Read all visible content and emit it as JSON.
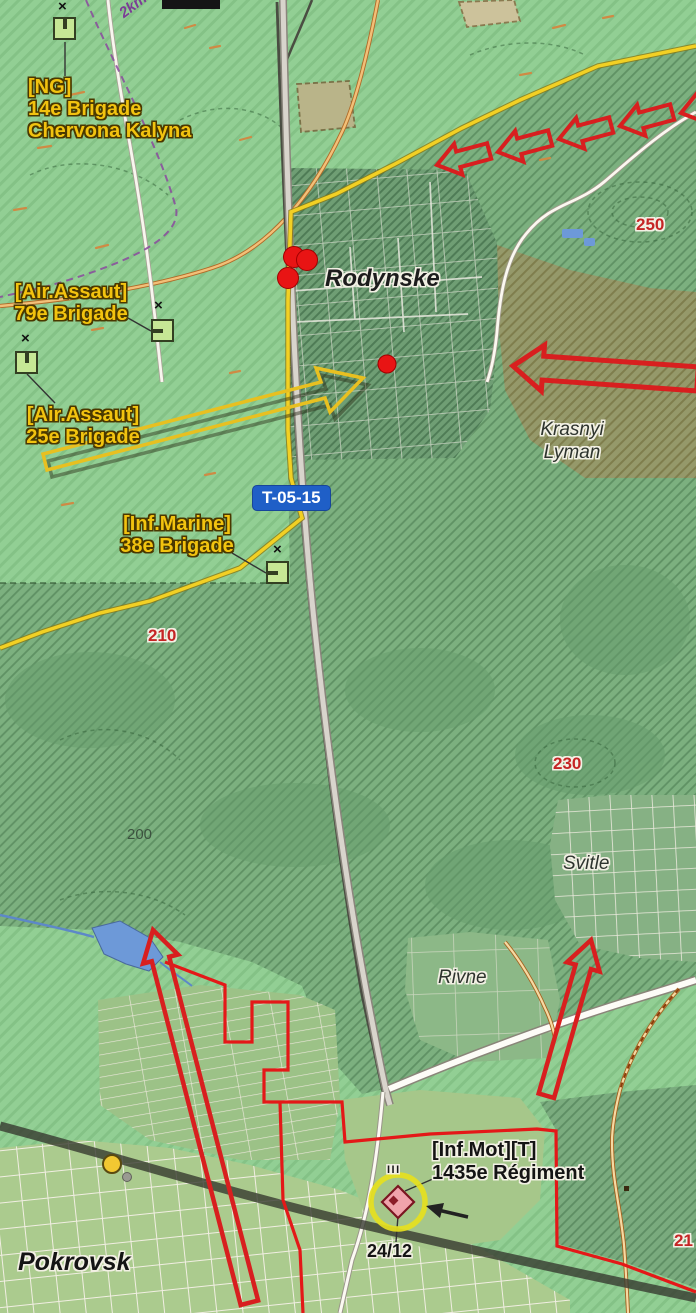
{
  "labels": {
    "units": [
      {
        "id": "ng-14",
        "lines": [
          "[NG]",
          "14e Brigade",
          "Chervona Kalyna"
        ]
      },
      {
        "id": "airassault-79",
        "lines": [
          "[Air.Assaut]",
          "79e Brigade"
        ]
      },
      {
        "id": "airassault-25",
        "lines": [
          "[Air.Assaut]",
          "25e Brigade"
        ]
      },
      {
        "id": "marine-38",
        "lines": [
          "[Inf.Marine]",
          "38e Brigade"
        ]
      },
      {
        "id": "motorized-1435",
        "lines": [
          "[Inf.Mot][T]",
          "1435e Régiment"
        ]
      }
    ],
    "places": {
      "rodynske": "Rodynske",
      "pokrovsk": "Pokrovsk",
      "krasnyi_line1": "Krasnyi",
      "krasnyi_line2": "Lyman",
      "svitle": "Svitle",
      "rivne": "Rivne"
    },
    "elevations": {
      "h250": "250",
      "h210": "210",
      "h230": "230",
      "s200": "200",
      "h21x": "21"
    },
    "road_shield": "T-05-15",
    "date_marker": "24/12",
    "distance_marker": "2km to",
    "unit_size_marker": "III",
    "x_marker": "×"
  },
  "colors": {
    "friendly_label_yellow": "#f2c30f",
    "enemy_arrow_red": "#d81f1f",
    "frontline_red": "#e41818",
    "advance_arrow_yellow": "#f2d024",
    "boundary_line_yellow": "#f2d024",
    "road_shield_blue": "#1f5fc7",
    "elevation_red": "#c52525",
    "water_blue": "#6d99d8",
    "unit_icon_green": "#c6e795",
    "occupied_zone_green": "#7cb07f",
    "strike_dot_red": "#e81414",
    "objective_ring_yellow": "#e6df1e"
  }
}
